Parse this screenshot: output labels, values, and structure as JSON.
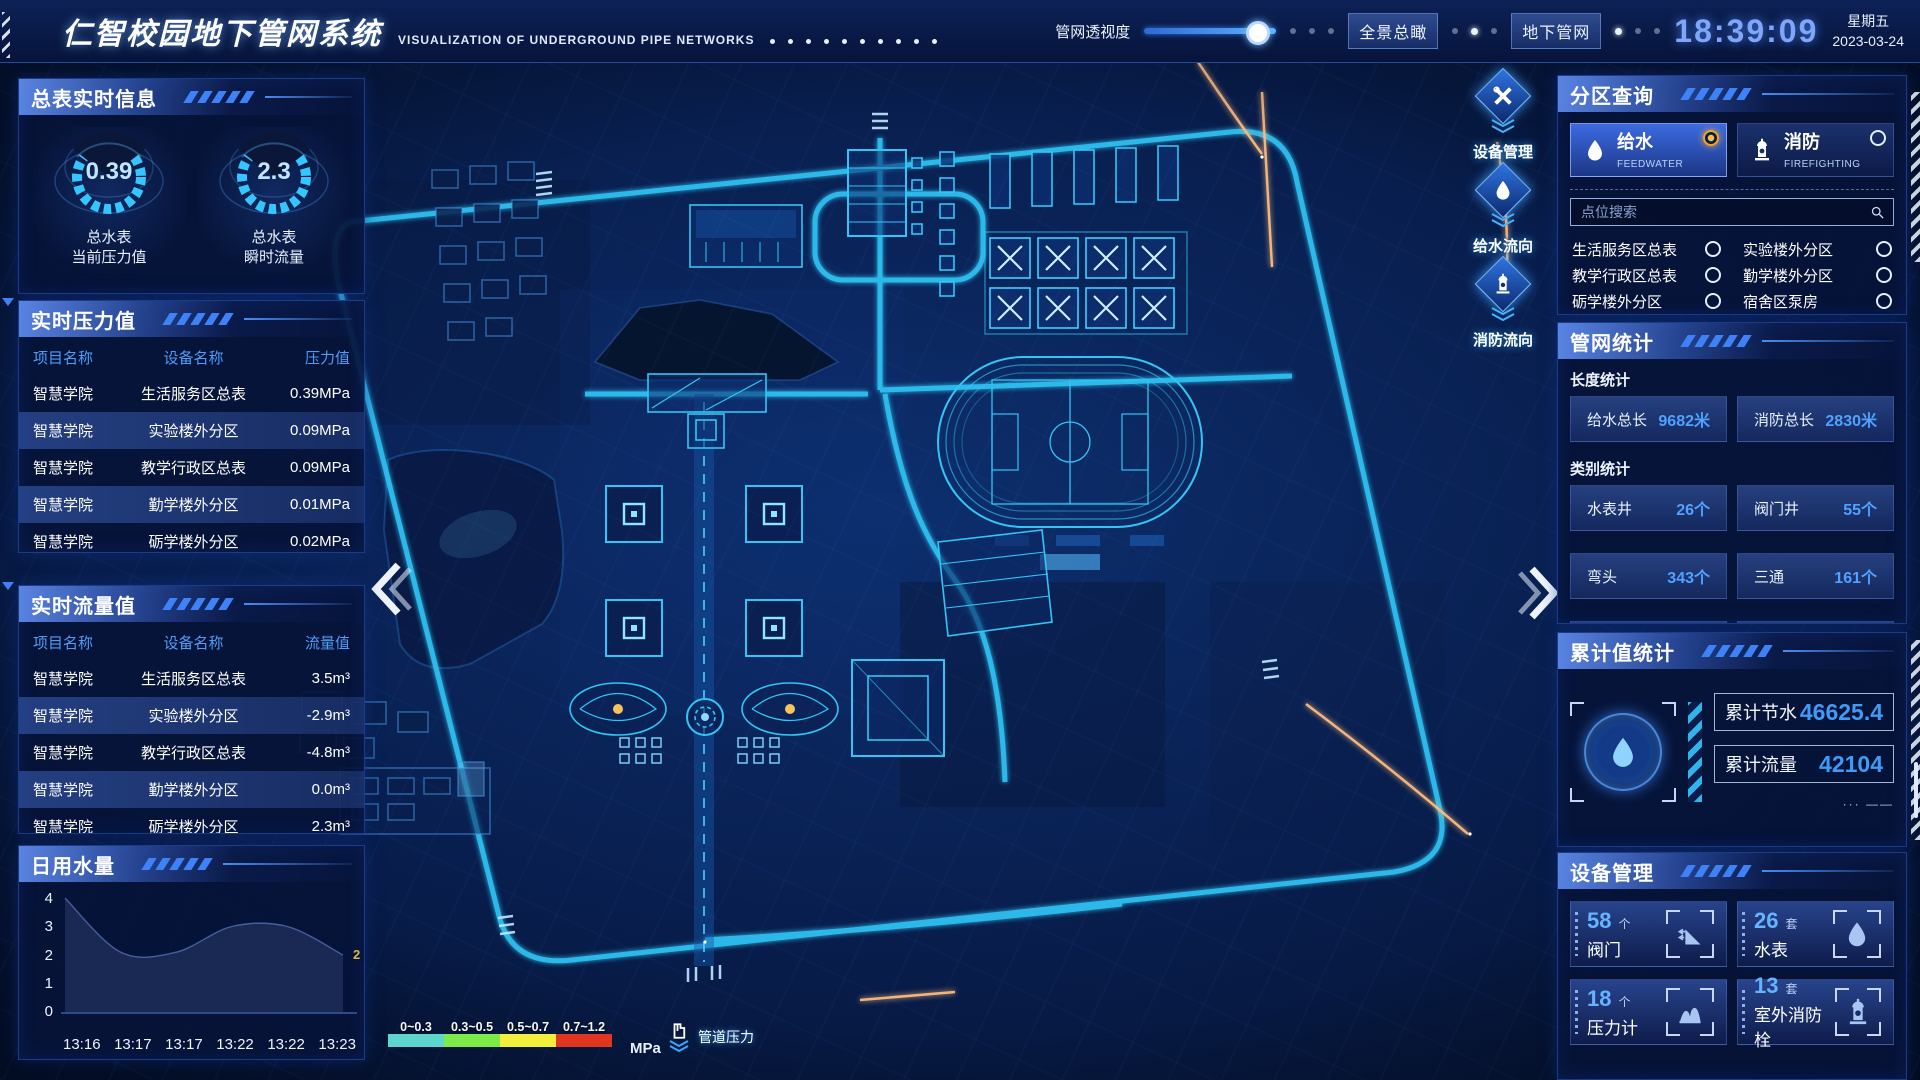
{
  "header": {
    "title": "仁智校园地下管网系统",
    "subtitle": "VISUALIZATION OF UNDERGROUND PIPE NETWORKS",
    "transparency_label": "管网透视度",
    "btn_overview": "全景总瞰",
    "btn_underground": "地下管网",
    "clock": "18:39:09",
    "weekday": "星期五",
    "date": "2023-03-24"
  },
  "left": {
    "meter_panel": {
      "title": "总表实时信息",
      "gauges": [
        {
          "value": "0.39",
          "line1": "总水表",
          "line2": "当前压力值"
        },
        {
          "value": "2.3",
          "line1": "总水表",
          "line2": "瞬时流量"
        }
      ]
    },
    "pressure_panel": {
      "title": "实时压力值",
      "columns": [
        "项目名称",
        "设备名称",
        "压力值"
      ],
      "rows": [
        {
          "project": "智慧学院",
          "device": "生活服务区总表",
          "value": "0.39MPa"
        },
        {
          "project": "智慧学院",
          "device": "实验楼外分区",
          "value": "0.09MPa"
        },
        {
          "project": "智慧学院",
          "device": "教学行政区总表",
          "value": "0.09MPa"
        },
        {
          "project": "智慧学院",
          "device": "勤学楼外分区",
          "value": "0.01MPa"
        },
        {
          "project": "智慧学院",
          "device": "砺学楼外分区",
          "value": "0.02MPa"
        }
      ]
    },
    "flow_panel": {
      "title": "实时流量值",
      "columns": [
        "项目名称",
        "设备名称",
        "流量值"
      ],
      "rows": [
        {
          "project": "智慧学院",
          "device": "生活服务区总表",
          "value": "3.5m³"
        },
        {
          "project": "智慧学院",
          "device": "实验楼外分区",
          "value": "-2.9m³"
        },
        {
          "project": "智慧学院",
          "device": "教学行政区总表",
          "value": "-4.8m³"
        },
        {
          "project": "智慧学院",
          "device": "勤学楼外分区",
          "value": "0.0m³"
        },
        {
          "project": "智慧学院",
          "device": "砺学楼外分区",
          "value": "2.3m³"
        }
      ]
    },
    "daily_panel": {
      "title": "日用水量"
    }
  },
  "chart_data": {
    "type": "area",
    "title": "日用水量",
    "x": [
      "13:16",
      "13:17",
      "13:17",
      "13:22",
      "13:22",
      "13:23"
    ],
    "values": [
      4,
      2.1,
      2.1,
      3,
      3,
      2
    ],
    "ylim": [
      0,
      4
    ],
    "ytick_labels": [
      "4",
      "3",
      "2",
      "1",
      "0"
    ],
    "end_label": "2",
    "end_label_color": "#d8b945",
    "xlabel": "",
    "ylabel": "",
    "grid": false,
    "legend_position": "none"
  },
  "right": {
    "zone_panel": {
      "title": "分区查询",
      "tabs": [
        {
          "name": "给水",
          "en": "FEEDWATER",
          "icon": "water-drop-icon",
          "selected": true
        },
        {
          "name": "消防",
          "en": "FIREFIGHTING",
          "icon": "hydrant-icon",
          "selected": false
        }
      ],
      "search_placeholder": "点位搜索",
      "items": [
        "生活服务区总表",
        "实验楼外分区",
        "教学行政区总表",
        "勤学楼外分区",
        "砺学楼外分区",
        "宿舍区泵房"
      ]
    },
    "stats_panel": {
      "title": "管网统计",
      "length_label": "长度统计",
      "length_stats": [
        {
          "label": "给水总长",
          "value": "9682米"
        },
        {
          "label": "消防总长",
          "value": "2830米"
        }
      ],
      "category_label": "类别统计",
      "category_stats": [
        {
          "label": "水表井",
          "value": "26个"
        },
        {
          "label": "阀门井",
          "value": "55个"
        },
        {
          "label": "弯头",
          "value": "343个"
        },
        {
          "label": "三通",
          "value": "161个"
        }
      ]
    },
    "cumulative_panel": {
      "title": "累计值统计",
      "stats": [
        {
          "label": "累计节水",
          "value": "46625.4"
        },
        {
          "label": "累计流量",
          "value": "42104"
        }
      ]
    },
    "device_panel": {
      "title": "设备管理",
      "cards": [
        {
          "count": "58",
          "unit": "个",
          "label": "阀门",
          "icon": "valve-icon"
        },
        {
          "count": "26",
          "unit": "套",
          "label": "水表",
          "icon": "water-drop-icon"
        },
        {
          "count": "18",
          "unit": "个",
          "label": "压力计",
          "icon": "pressure-gauge-icon"
        },
        {
          "count": "13",
          "unit": "套",
          "label": "室外消防栓",
          "icon": "hydrant-icon"
        }
      ]
    }
  },
  "map": {
    "side_buttons": [
      {
        "label": "设备管理",
        "icon": "tools-icon"
      },
      {
        "label": "给水流向",
        "icon": "water-drop-icon"
      },
      {
        "label": "消防流向",
        "icon": "hydrant-icon"
      }
    ],
    "legend": {
      "ranges": [
        "0~0.3",
        "0.3~0.5",
        "0.5~0.7",
        "0.7~1.2"
      ],
      "colors": [
        "#5fd6cd",
        "#7dea49",
        "#f2ee3e",
        "#e0361f"
      ],
      "unit": "MPa",
      "pressure_label": "管道压力"
    }
  },
  "colors": {
    "accent_blue": "#3f8cf5",
    "value_blue": "#4fa2ff",
    "gauge_cyan": "#35c5ff",
    "selected_orange": "#f0a428",
    "clock_blue": "#7fa6f9"
  }
}
